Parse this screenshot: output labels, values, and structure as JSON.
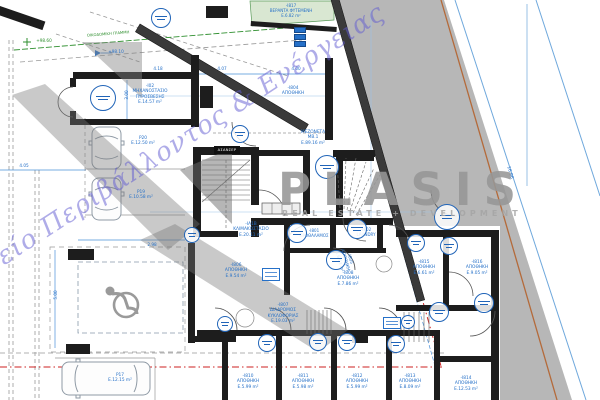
{
  "watermark": {
    "office": "Γραφείο Περιβάλλοντος & Ενέργειας",
    "brand": "PLASIS",
    "brand_subtitle": "REAL ESTATE + DEVELOPMENT"
  },
  "colors": {
    "dim_blue": "#2570c8",
    "survey_blue": "#6fa8dc",
    "green": "#2f8f2f",
    "red": "#cc2222",
    "orange": "#b46a3a",
    "wall_black": "#1d1d1d",
    "street_gray": "#b7b7b7",
    "stamp_blue": "#2064b8",
    "watermark_violet": "rgba(95,90,210,0.5)",
    "watermark_gray": "#9c9c9c"
  },
  "elevator_label": "ΑΣΑΝΣΕΡ",
  "labels": [
    {
      "n": "room-label-fire-pump",
      "t": "-Ι02\nΜΗΧΑΝΟΣΤΑΣΙΟ\nΠΥΡΟΣΒΕΣΗΣ\nΕ.14.57 m²",
      "x": 150,
      "y": 84,
      "s": 4.3
    },
    {
      "n": "room-label-i804",
      "t": "-Ι804\nΑΠΟΘΗΚΗ",
      "x": 293,
      "y": 86,
      "s": 4.3
    },
    {
      "n": "room-label-mezoneta",
      "t": "ΜΕΖΟΝΕΤΑ\nΜΒ.1\nΕ.89.16 m²",
      "x": 313,
      "y": 130,
      "s": 4.3
    },
    {
      "n": "room-label-veranda",
      "t": "-Ι817\nΒΕΡΑΝΤΑ ΦΥΤΕΜΕΝΗ\nΕ.6.82 m²",
      "x": 291,
      "y": 3,
      "s": 4
    },
    {
      "n": "room-label-stairwell",
      "t": "-ΙΑ1Β\nΚΛΙΜΑΚΟΣΤΑΣΙΟ\nΕ.20.11 m²",
      "x": 251,
      "y": 222,
      "s": 4.3
    },
    {
      "n": "room-label-i801",
      "t": "-Ι801\nΠΡΟΘΑΛΑΜΟΣ",
      "x": 314,
      "y": 228,
      "s": 4
    },
    {
      "n": "room-label-i802",
      "t": "-Ι802\nLAUNDRY",
      "x": 366,
      "y": 227,
      "s": 4
    },
    {
      "n": "room-label-i808",
      "t": "-Ι808\nΑΠΟΘΗΚΗ\nΕ.7.86 m²",
      "x": 348,
      "y": 271,
      "s": 4.3
    },
    {
      "n": "room-label-i807",
      "t": "-Ι807\nΔΙΑΔΡΟΜΟΣ\nΚΥΚΛΟΦΟΡΙΑΣ\nΕ.19.03 m²",
      "x": 283,
      "y": 303,
      "s": 4.3
    },
    {
      "n": "room-label-i806",
      "t": "-Ι806\nΑΠΟΘΗΚΗ\nΕ.9.54 m²",
      "x": 236,
      "y": 263,
      "s": 4.3
    },
    {
      "n": "room-label-i805",
      "t": "-Ι805\nΑΠΟΘΗΚΗ\nΕ.6.63 m²",
      "x": 352,
      "y": 258,
      "s": 4.3,
      "r": 74
    },
    {
      "n": "room-label-i815",
      "t": "-Ι815\nΑΠΟΘΗΚΗ\nΕ.6.61 m²",
      "x": 424,
      "y": 260,
      "s": 4.3
    },
    {
      "n": "room-label-i816",
      "t": "-Ι816\nΑΠΟΘΗΚΗ\nΕ.9.05 m²",
      "x": 477,
      "y": 260,
      "s": 4.3
    },
    {
      "n": "room-label-i810",
      "t": "-Ι810\nΑΠΟΘΗΚΗ\nΕ.5.99 m²",
      "x": 248,
      "y": 374,
      "s": 4.3
    },
    {
      "n": "room-label-i811",
      "t": "-Ι811\nΑΠΟΘΗΚΗ\nΕ.5.98 m²",
      "x": 303,
      "y": 374,
      "s": 4.3
    },
    {
      "n": "room-label-i812",
      "t": "-Ι812\nΑΠΟΘΗΚΗ\nΕ.5.99 m²",
      "x": 357,
      "y": 374,
      "s": 4.3
    },
    {
      "n": "room-label-i813",
      "t": "-Ι813\nΑΠΟΘΗΚΗ\nΕ.8.09 m²",
      "x": 410,
      "y": 374,
      "s": 4.3
    },
    {
      "n": "room-label-i814",
      "t": "-Ι814\nΑΠΟΘΗΚΗ\nΕ.12.53 m²",
      "x": 466,
      "y": 376,
      "s": 4.3
    },
    {
      "n": "parking-label-p20",
      "t": "P20\nΕ.12.50 m²",
      "x": 143,
      "y": 136,
      "s": 4.3
    },
    {
      "n": "parking-label-p19",
      "t": "P19\nΕ.10.58 m²",
      "x": 141,
      "y": 190,
      "s": 4.3
    },
    {
      "n": "parking-label-p17",
      "t": "P17\nΕ.12.15 m²",
      "x": 120,
      "y": 373,
      "s": 4.3
    },
    {
      "n": "elevation-label-green",
      "t": "+98.60",
      "x": 44,
      "y": 38,
      "s": 4.2,
      "c": "g"
    },
    {
      "n": "elevation-label-blue",
      "t": "+98.10",
      "x": 116,
      "y": 49,
      "s": 4.2
    },
    {
      "n": "boundary-line-label",
      "t": "ΟΙΚΟΔΟΜΙΚΗ ΓΡΑΜΜΗ",
      "x": 108,
      "y": 32,
      "s": 3.8,
      "c": "g",
      "r": -4.5
    },
    {
      "n": "dim-label-418",
      "t": "4.18",
      "x": 158,
      "y": 66,
      "s": 4.2
    },
    {
      "n": "dim-label-407",
      "t": "4.07",
      "x": 222,
      "y": 66,
      "s": 4.2
    },
    {
      "n": "dim-label-400",
      "t": "4.00",
      "x": 296,
      "y": 66,
      "s": 4.2
    },
    {
      "n": "dim-label-300",
      "t": "3.00",
      "x": 124,
      "y": 95,
      "s": 4.2,
      "r": -90
    },
    {
      "n": "dim-label-405",
      "t": "4.05",
      "x": 24,
      "y": 163,
      "s": 4.2
    },
    {
      "n": "dim-label-500",
      "t": "5.00",
      "x": 53,
      "y": 295,
      "s": 4.2,
      "r": -90
    },
    {
      "n": "dim-label-298",
      "t": "2.98",
      "x": 152,
      "y": 242,
      "s": 4.2
    },
    {
      "n": "dim-label-1696",
      "t": "16.96",
      "x": 512,
      "y": 172,
      "s": 4.5,
      "r": 74
    }
  ],
  "stamps": [
    [
      103,
      98,
      13
    ],
    [
      161,
      18,
      10
    ],
    [
      240,
      134,
      9
    ],
    [
      327,
      167,
      12
    ],
    [
      447,
      217,
      13
    ],
    [
      297,
      233,
      10
    ],
    [
      357,
      229,
      10
    ],
    [
      336,
      260,
      10
    ],
    [
      416,
      243,
      9
    ],
    [
      449,
      246,
      9
    ],
    [
      439,
      312,
      10
    ],
    [
      484,
      303,
      10
    ],
    [
      225,
      324,
      8
    ],
    [
      267,
      343,
      9
    ],
    [
      318,
      342,
      9
    ],
    [
      347,
      342,
      9
    ],
    [
      396,
      344,
      9
    ],
    [
      192,
      235,
      8
    ],
    [
      408,
      322,
      7
    ]
  ]
}
